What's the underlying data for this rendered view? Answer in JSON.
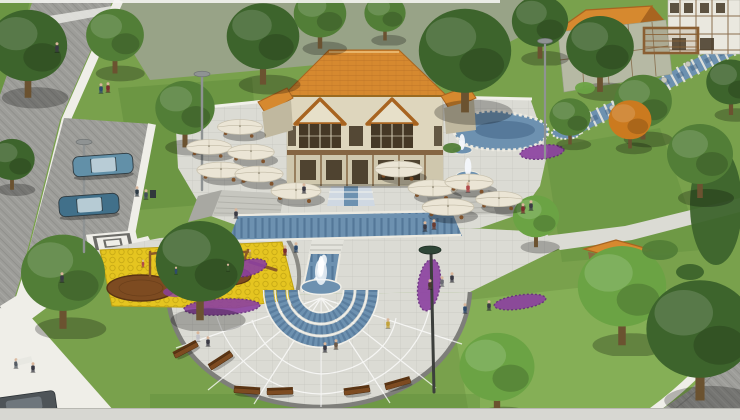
{
  "meta": {
    "alt": "Aerial 3D architectural rendering of a landscaped public park plaza with a two-storey orange-roofed building, axial cascading fountains, cafe umbrellas, a yellow playground, a rocky stream, a pond, tree-lined roads and parked cars",
    "view": "bird's-eye perspective render",
    "visible_text": ""
  },
  "scene": {
    "landmarks": [
      "two-storey community building with orange tiled roof and twin gables",
      "terrace with white cafe umbrellas",
      "axial water cascade with arched tile pool",
      "semicircular tiered fountain with jet",
      "large semicircular paved plaza with radial joints and benches",
      "children's playground with yellow safety surface and timber equipment",
      "kidney-shaped rock-edged pond",
      "rocky cascading stream below upper stone building",
      "pergola and timber-framed buildings at upper right",
      "diagonal cobbled road with crosswalk and parking bay",
      "decorative concentric-square paving motif",
      "small orange-roofed kiosk among trees",
      "purple flower beds",
      "autumn orange tree"
    ],
    "counts": {
      "umbrellas": 11,
      "trees": 21,
      "people": 31,
      "benches": 6,
      "lamp_posts": 4,
      "cars": 3,
      "flower_beds": 6,
      "playground_decks": 2,
      "water_features": 6
    }
  },
  "palette": {
    "grass": "#79a14c",
    "grassDark": "#5d8a3a",
    "grassBright": "#8fbc5e",
    "field": "#98a387",
    "roadGray": "#9d9d99",
    "roadDark": "#7e7e7a",
    "pavement": "#dbdbd4",
    "pavementDim": "#c6c6bf",
    "sidewalk": "#efeee8",
    "curb": "#b3b3ac",
    "roofOrange": "#d6892f",
    "roofOrangeDark": "#a86420",
    "wallCream": "#ded6bd",
    "wallShadow": "#c0b89f",
    "gableCream": "#e7e0c9",
    "timber": "#7b5934",
    "windowDark": "#453826",
    "stoneWall": "#b6b9a4",
    "whiteWall": "#eae8df",
    "waterBlue": "#6d91b0",
    "waterDark": "#3f6184",
    "spray": "#f4f8fc",
    "umbrella": "#ebe5d5",
    "playYellow": "#e5c520",
    "playYellowDark": "#bfa113",
    "purple": "#8c40a1",
    "purpleDark": "#662a7e",
    "wood": "#7d4b21",
    "woodDark": "#5a3413",
    "treeDark": "#3d642c",
    "treeMid": "#527e37",
    "treeBright": "#6ba344",
    "autumn": "#cb7a1f",
    "carTeal": "#6290a8",
    "carTealDark": "#41708a",
    "carDark": "#4e5458",
    "lamp": "#8f9393",
    "lampDark": "#2e4637",
    "skin": "#d9b69b"
  }
}
